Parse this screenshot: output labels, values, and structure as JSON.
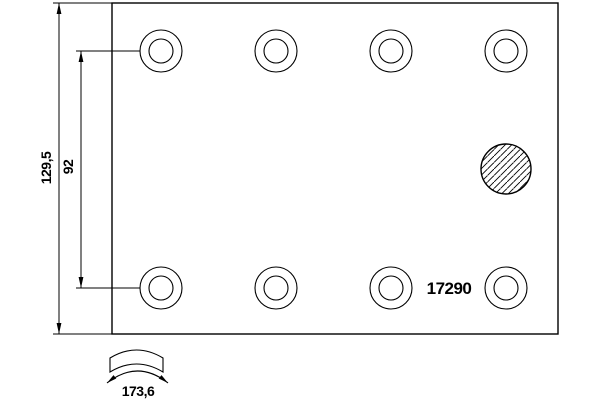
{
  "drawing": {
    "part_number": "17290",
    "dim_overall_height": "129,5",
    "dim_hole_row_spacing": "92",
    "dim_arc_width": "173,6"
  },
  "colors": {
    "line": "#000000",
    "background": "#ffffff"
  }
}
